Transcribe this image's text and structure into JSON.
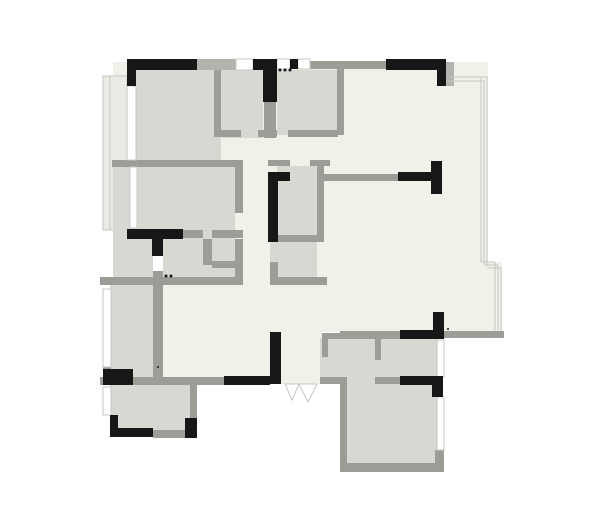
{
  "plan": {
    "canvas": {
      "w": 600,
      "h": 522
    },
    "colors": {
      "floor": "#f1f1ea",
      "room": "#d8d8d2",
      "balcony": "#ebebe6",
      "wall": "#9d9d97",
      "wallLight": "#b3b3ae",
      "thin": "#c7c7c2",
      "black": "#171717",
      "white": "#ffffff"
    },
    "shapes": [
      {
        "t": "rect",
        "n": "floor-main-area",
        "x": 113,
        "y": 62,
        "w": 375,
        "h": 270,
        "f": "floor"
      },
      {
        "t": "rect",
        "n": "floor-bay-step",
        "x": 488,
        "y": 262,
        "w": 14,
        "h": 70,
        "f": "floor"
      },
      {
        "t": "rect",
        "n": "floor-entry-hall",
        "x": 160,
        "y": 283,
        "w": 162,
        "h": 101,
        "f": "floor"
      },
      {
        "t": "rect",
        "n": "balcony-west",
        "x": 103,
        "y": 76,
        "w": 24,
        "h": 154,
        "f": "balcony",
        "s": "thin",
        "sw": 1
      },
      {
        "t": "line",
        "n": "balcony-west-inner-line",
        "x1": 110,
        "y1": 76,
        "x2": 110,
        "y2": 230,
        "s": "thin",
        "sw": 1
      },
      {
        "t": "rect",
        "n": "room-topleft-bedroom-fill",
        "x": 127,
        "y": 70,
        "w": 94,
        "h": 92,
        "f": "room"
      },
      {
        "t": "rect",
        "n": "room-topmid-a-fill",
        "x": 221,
        "y": 70,
        "w": 42,
        "h": 68,
        "f": "room"
      },
      {
        "t": "rect",
        "n": "room-topmid-b-fill",
        "x": 277,
        "y": 70,
        "w": 60,
        "h": 65,
        "f": "room"
      },
      {
        "t": "rect",
        "n": "room-midleft-bedroom-fill",
        "x": 113,
        "y": 167,
        "w": 122,
        "h": 72,
        "f": "room"
      },
      {
        "t": "rect",
        "n": "room-midleft-bath-fill",
        "x": 113,
        "y": 239,
        "w": 125,
        "h": 44,
        "f": "room"
      },
      {
        "t": "rect",
        "n": "room-central-bath-upper-fill",
        "x": 277,
        "y": 166,
        "w": 40,
        "h": 70,
        "f": "room"
      },
      {
        "t": "rect",
        "n": "room-central-bath-lower-fill",
        "x": 270,
        "y": 236,
        "w": 47,
        "h": 41,
        "f": "room"
      },
      {
        "t": "rect",
        "n": "room-left-narrow-fill",
        "x": 110,
        "y": 283,
        "w": 43,
        "h": 94,
        "f": "room"
      },
      {
        "t": "rect",
        "n": "room-bottomleft-fill",
        "x": 110,
        "y": 384,
        "w": 80,
        "h": 46,
        "f": "room"
      },
      {
        "t": "rect",
        "n": "room-bottomright-upper-fill",
        "x": 320,
        "y": 338,
        "w": 117,
        "h": 46,
        "f": "room"
      },
      {
        "t": "rect",
        "n": "room-bottomright-lower-fill",
        "x": 347,
        "y": 384,
        "w": 90,
        "h": 79,
        "f": "room"
      },
      {
        "t": "rect",
        "n": "wall-segment",
        "x": 112,
        "y": 160,
        "w": 131,
        "h": 7,
        "f": "wall"
      },
      {
        "t": "rect",
        "n": "wall-segment",
        "x": 214,
        "y": 62,
        "w": 7,
        "h": 75,
        "f": "wall"
      },
      {
        "t": "rect",
        "n": "wall-segment",
        "x": 221,
        "y": 130,
        "w": 20,
        "h": 7,
        "f": "wall"
      },
      {
        "t": "rect",
        "n": "wall-segment",
        "x": 258,
        "y": 130,
        "w": 19,
        "h": 7,
        "f": "wall"
      },
      {
        "t": "rect",
        "n": "wall-segment",
        "x": 264,
        "y": 100,
        "w": 12,
        "h": 38,
        "f": "wall"
      },
      {
        "t": "rect",
        "n": "wall-segment",
        "x": 288,
        "y": 130,
        "w": 50,
        "h": 7,
        "f": "wall"
      },
      {
        "t": "rect",
        "n": "wall-segment",
        "x": 337,
        "y": 62,
        "w": 7,
        "h": 73,
        "f": "wall"
      },
      {
        "t": "rect",
        "n": "wall-segment",
        "x": 268,
        "y": 160,
        "w": 22,
        "h": 6,
        "f": "wall"
      },
      {
        "t": "rect",
        "n": "wall-segment",
        "x": 310,
        "y": 160,
        "w": 20,
        "h": 6,
        "f": "wall"
      },
      {
        "t": "rect",
        "n": "wall-segment",
        "x": 317,
        "y": 160,
        "w": 7,
        "h": 76,
        "f": "wall"
      },
      {
        "t": "rect",
        "n": "wall-segment",
        "x": 277,
        "y": 235,
        "w": 47,
        "h": 7,
        "f": "wall"
      },
      {
        "t": "rect",
        "n": "wall-segment",
        "x": 270,
        "y": 277,
        "w": 57,
        "h": 8,
        "f": "wall"
      },
      {
        "t": "rect",
        "n": "wall-segment",
        "x": 270,
        "y": 262,
        "w": 8,
        "h": 15,
        "f": "wall"
      },
      {
        "t": "rect",
        "n": "wall-segment",
        "x": 324,
        "y": 174,
        "w": 76,
        "h": 7,
        "f": "wall"
      },
      {
        "t": "rect",
        "n": "wall-segment",
        "x": 235,
        "y": 163,
        "w": 8,
        "h": 50,
        "f": "wall"
      },
      {
        "t": "rect",
        "n": "wall-segment",
        "x": 183,
        "y": 230,
        "w": 20,
        "h": 8,
        "f": "wall"
      },
      {
        "t": "rect",
        "n": "wall-segment",
        "x": 212,
        "y": 230,
        "w": 31,
        "h": 8,
        "f": "wall"
      },
      {
        "t": "rect",
        "n": "wall-segment",
        "x": 153,
        "y": 271,
        "w": 10,
        "h": 14,
        "f": "wall"
      },
      {
        "t": "rect",
        "n": "wall-segment",
        "x": 203,
        "y": 239,
        "w": 9,
        "h": 26,
        "f": "wall"
      },
      {
        "t": "rect",
        "n": "wall-segment",
        "x": 212,
        "y": 261,
        "w": 31,
        "h": 7,
        "f": "wall"
      },
      {
        "t": "rect",
        "n": "wall-segment",
        "x": 235,
        "y": 239,
        "w": 8,
        "h": 38,
        "f": "wall"
      },
      {
        "t": "rect",
        "n": "wall-segment",
        "x": 100,
        "y": 277,
        "w": 143,
        "h": 8,
        "f": "wall"
      },
      {
        "t": "rect",
        "n": "wall-segment",
        "x": 103,
        "y": 367,
        "w": 8,
        "h": 12,
        "f": "wall"
      },
      {
        "t": "rect",
        "n": "wall-segment",
        "x": 153,
        "y": 285,
        "w": 10,
        "h": 95,
        "f": "wall"
      },
      {
        "t": "rect",
        "n": "wall-segment",
        "x": 100,
        "y": 377,
        "w": 97,
        "h": 8,
        "f": "wall"
      },
      {
        "t": "rect",
        "n": "wall-segment",
        "x": 190,
        "y": 385,
        "w": 7,
        "h": 33,
        "f": "wall"
      },
      {
        "t": "rect",
        "n": "wall-segment",
        "x": 153,
        "y": 430,
        "w": 44,
        "h": 8,
        "f": "wall"
      },
      {
        "t": "rect",
        "n": "wall-segment",
        "x": 193,
        "y": 377,
        "w": 31,
        "h": 8,
        "f": "wall"
      },
      {
        "t": "rect",
        "n": "wall-segment",
        "x": 340,
        "y": 331,
        "w": 60,
        "h": 7,
        "f": "wall"
      },
      {
        "t": "rect",
        "n": "wall-segment",
        "x": 438,
        "y": 331,
        "w": 66,
        "h": 7,
        "f": "wall"
      },
      {
        "t": "rect",
        "n": "wall-segment",
        "x": 322,
        "y": 333,
        "w": 115,
        "h": 6,
        "f": "wall"
      },
      {
        "t": "rect",
        "n": "wall-segment",
        "x": 322,
        "y": 338,
        "w": 6,
        "h": 19,
        "f": "wall"
      },
      {
        "t": "rect",
        "n": "wall-segment",
        "x": 320,
        "y": 377,
        "w": 27,
        "h": 7,
        "f": "wall"
      },
      {
        "t": "rect",
        "n": "wall-segment",
        "x": 340,
        "y": 384,
        "w": 7,
        "h": 82,
        "f": "wall"
      },
      {
        "t": "rect",
        "n": "wall-segment",
        "x": 340,
        "y": 463,
        "w": 104,
        "h": 9,
        "f": "wall"
      },
      {
        "t": "rect",
        "n": "wall-segment",
        "x": 375,
        "y": 338,
        "w": 6,
        "h": 22,
        "f": "wall"
      },
      {
        "t": "rect",
        "n": "wall-segment",
        "x": 375,
        "y": 377,
        "w": 25,
        "h": 7,
        "f": "wall"
      },
      {
        "t": "rect",
        "n": "wall-segment",
        "x": 435,
        "y": 450,
        "w": 9,
        "h": 13,
        "f": "wall"
      },
      {
        "t": "rect",
        "n": "wall-segment-light",
        "x": 197,
        "y": 59,
        "w": 39,
        "h": 11,
        "f": "wallLight"
      },
      {
        "t": "rect",
        "n": "wall-segment",
        "x": 308,
        "y": 61,
        "w": 78,
        "h": 8,
        "f": "wall"
      },
      {
        "t": "rect",
        "n": "wall-segment-light",
        "x": 446,
        "y": 62,
        "w": 8,
        "h": 24,
        "f": "wallLight"
      },
      {
        "t": "rect",
        "n": "window",
        "x": 236,
        "y": 59,
        "w": 17,
        "h": 11,
        "f": "white",
        "s": "thin",
        "sw": 1
      },
      {
        "t": "rect",
        "n": "window",
        "x": 277,
        "y": 59,
        "w": 13,
        "h": 10,
        "f": "white",
        "s": "thin",
        "sw": 1
      },
      {
        "t": "rect",
        "n": "window",
        "x": 298,
        "y": 59,
        "w": 12,
        "h": 10,
        "f": "white",
        "s": "thin",
        "sw": 1
      },
      {
        "t": "rect",
        "n": "window",
        "x": 127,
        "y": 86,
        "w": 9,
        "h": 74,
        "f": "white",
        "s": "thin",
        "sw": 1
      },
      {
        "t": "rect",
        "n": "window",
        "x": 130,
        "y": 167,
        "w": 7,
        "h": 61,
        "f": "white",
        "s": "thin",
        "sw": 1
      },
      {
        "t": "rect",
        "n": "window",
        "x": 103,
        "y": 289,
        "w": 8,
        "h": 78,
        "f": "white",
        "s": "thin",
        "sw": 1
      },
      {
        "t": "rect",
        "n": "window",
        "x": 103,
        "y": 387,
        "w": 8,
        "h": 28,
        "f": "white",
        "s": "thin",
        "sw": 1
      },
      {
        "t": "rect",
        "n": "window",
        "x": 437,
        "y": 340,
        "w": 7,
        "h": 37,
        "f": "white",
        "s": "thin",
        "sw": 1
      },
      {
        "t": "rect",
        "n": "window",
        "x": 437,
        "y": 397,
        "w": 7,
        "h": 53,
        "f": "white",
        "s": "thin",
        "sw": 1
      },
      {
        "t": "rect",
        "n": "door-gap",
        "x": 153,
        "y": 256,
        "w": 10,
        "h": 15,
        "f": "white"
      },
      {
        "t": "line",
        "n": "window-line",
        "x1": 446,
        "y1": 77,
        "x2": 487,
        "y2": 77,
        "s": "thin",
        "sw": 1
      },
      {
        "t": "line",
        "n": "window-line",
        "x1": 446,
        "y1": 81,
        "x2": 484,
        "y2": 81,
        "s": "thin",
        "sw": 1
      },
      {
        "t": "line",
        "n": "window-line",
        "x1": 481,
        "y1": 77,
        "x2": 481,
        "y2": 262,
        "s": "thin",
        "sw": 1
      },
      {
        "t": "line",
        "n": "window-line",
        "x1": 484,
        "y1": 80,
        "x2": 484,
        "y2": 264,
        "s": "thin",
        "sw": 1
      },
      {
        "t": "line",
        "n": "window-line",
        "x1": 487,
        "y1": 77,
        "x2": 487,
        "y2": 266,
        "s": "thin",
        "sw": 1
      },
      {
        "t": "line",
        "n": "window-line",
        "x1": 481,
        "y1": 262,
        "x2": 495,
        "y2": 262,
        "s": "thin",
        "sw": 1
      },
      {
        "t": "line",
        "n": "window-line",
        "x1": 484,
        "y1": 265,
        "x2": 498,
        "y2": 265,
        "s": "thin",
        "sw": 1
      },
      {
        "t": "line",
        "n": "window-line",
        "x1": 487,
        "y1": 268,
        "x2": 501,
        "y2": 268,
        "s": "thin",
        "sw": 1
      },
      {
        "t": "line",
        "n": "window-line",
        "x1": 495,
        "y1": 262,
        "x2": 495,
        "y2": 331,
        "s": "thin",
        "sw": 1
      },
      {
        "t": "line",
        "n": "window-line",
        "x1": 498,
        "y1": 265,
        "x2": 498,
        "y2": 331,
        "s": "thin",
        "sw": 1
      },
      {
        "t": "line",
        "n": "window-line",
        "x1": 501,
        "y1": 268,
        "x2": 501,
        "y2": 331,
        "s": "thin",
        "sw": 1
      },
      {
        "t": "rect",
        "n": "wall-black-segment",
        "x": 127,
        "y": 59,
        "w": 70,
        "h": 11,
        "f": "black"
      },
      {
        "t": "rect",
        "n": "wall-black-segment",
        "x": 127,
        "y": 59,
        "w": 9,
        "h": 27,
        "f": "black"
      },
      {
        "t": "rect",
        "n": "wall-black-segment",
        "x": 253,
        "y": 59,
        "w": 24,
        "h": 11,
        "f": "black"
      },
      {
        "t": "rect",
        "n": "wall-black-segment",
        "x": 263,
        "y": 59,
        "w": 14,
        "h": 43,
        "f": "black"
      },
      {
        "t": "rect",
        "n": "wall-black-segment",
        "x": 290,
        "y": 59,
        "w": 8,
        "h": 10,
        "f": "black"
      },
      {
        "t": "rect",
        "n": "wall-black-segment",
        "x": 386,
        "y": 59,
        "w": 60,
        "h": 11,
        "f": "black"
      },
      {
        "t": "rect",
        "n": "wall-black-segment",
        "x": 437,
        "y": 59,
        "w": 9,
        "h": 27,
        "f": "black"
      },
      {
        "t": "rect",
        "n": "wall-black-segment",
        "x": 127,
        "y": 229,
        "w": 56,
        "h": 10,
        "f": "black"
      },
      {
        "t": "rect",
        "n": "wall-black-segment",
        "x": 152,
        "y": 229,
        "w": 11,
        "h": 27,
        "f": "black"
      },
      {
        "t": "rect",
        "n": "wall-black-segment",
        "x": 268,
        "y": 172,
        "w": 10,
        "h": 70,
        "f": "black"
      },
      {
        "t": "rect",
        "n": "wall-black-segment",
        "x": 268,
        "y": 172,
        "w": 22,
        "h": 9,
        "f": "black"
      },
      {
        "t": "rect",
        "n": "wall-black-segment",
        "x": 398,
        "y": 172,
        "w": 37,
        "h": 9,
        "f": "black"
      },
      {
        "t": "rect",
        "n": "wall-black-segment",
        "x": 431,
        "y": 161,
        "w": 11,
        "h": 33,
        "f": "black"
      },
      {
        "t": "rect",
        "n": "wall-black-segment",
        "x": 400,
        "y": 330,
        "w": 38,
        "h": 9,
        "f": "black"
      },
      {
        "t": "rect",
        "n": "wall-black-segment",
        "x": 433,
        "y": 312,
        "w": 11,
        "h": 27,
        "f": "black"
      },
      {
        "t": "rect",
        "n": "wall-black-segment",
        "x": 270,
        "y": 332,
        "w": 11,
        "h": 52,
        "f": "black"
      },
      {
        "t": "rect",
        "n": "wall-black-segment",
        "x": 224,
        "y": 376,
        "w": 46,
        "h": 9,
        "f": "black"
      },
      {
        "t": "rect",
        "n": "wall-black-segment",
        "x": 400,
        "y": 376,
        "w": 38,
        "h": 9,
        "f": "black"
      },
      {
        "t": "rect",
        "n": "wall-black-segment",
        "x": 432,
        "y": 376,
        "w": 11,
        "h": 21,
        "f": "black"
      },
      {
        "t": "rect",
        "n": "wall-black-segment",
        "x": 110,
        "y": 415,
        "w": 8,
        "h": 22,
        "f": "black"
      },
      {
        "t": "rect",
        "n": "wall-black-segment",
        "x": 110,
        "y": 428,
        "w": 43,
        "h": 9,
        "f": "black"
      },
      {
        "t": "rect",
        "n": "wall-black-segment",
        "x": 103,
        "y": 369,
        "w": 30,
        "h": 16,
        "f": "black"
      },
      {
        "t": "rect",
        "n": "wall-black-segment",
        "x": 185,
        "y": 418,
        "w": 12,
        "h": 20,
        "f": "black"
      },
      {
        "t": "poly",
        "n": "entry-door-leaf",
        "p": "285,384 299,384 292,400",
        "f": "white",
        "s": "thin",
        "sw": 1
      },
      {
        "t": "poly",
        "n": "entry-door-leaf",
        "p": "299,384 317,384 308,402",
        "f": "white",
        "s": "thin",
        "sw": 1
      },
      {
        "t": "dot",
        "n": "detail-dot",
        "cx": 280,
        "cy": 70,
        "r": 1.5
      },
      {
        "t": "dot",
        "n": "detail-dot",
        "cx": 285,
        "cy": 70,
        "r": 1.5
      },
      {
        "t": "dot",
        "n": "detail-dot",
        "cx": 290,
        "cy": 70,
        "r": 1.5
      },
      {
        "t": "dot",
        "n": "detail-dot",
        "cx": 166,
        "cy": 276,
        "r": 1.5
      },
      {
        "t": "dot",
        "n": "detail-dot",
        "cx": 171,
        "cy": 276,
        "r": 1.5
      },
      {
        "t": "dot",
        "n": "detail-dot",
        "cx": 158,
        "cy": 367,
        "r": 1
      },
      {
        "t": "dot",
        "n": "detail-dot",
        "cx": 448,
        "cy": 329,
        "r": 1
      }
    ]
  }
}
